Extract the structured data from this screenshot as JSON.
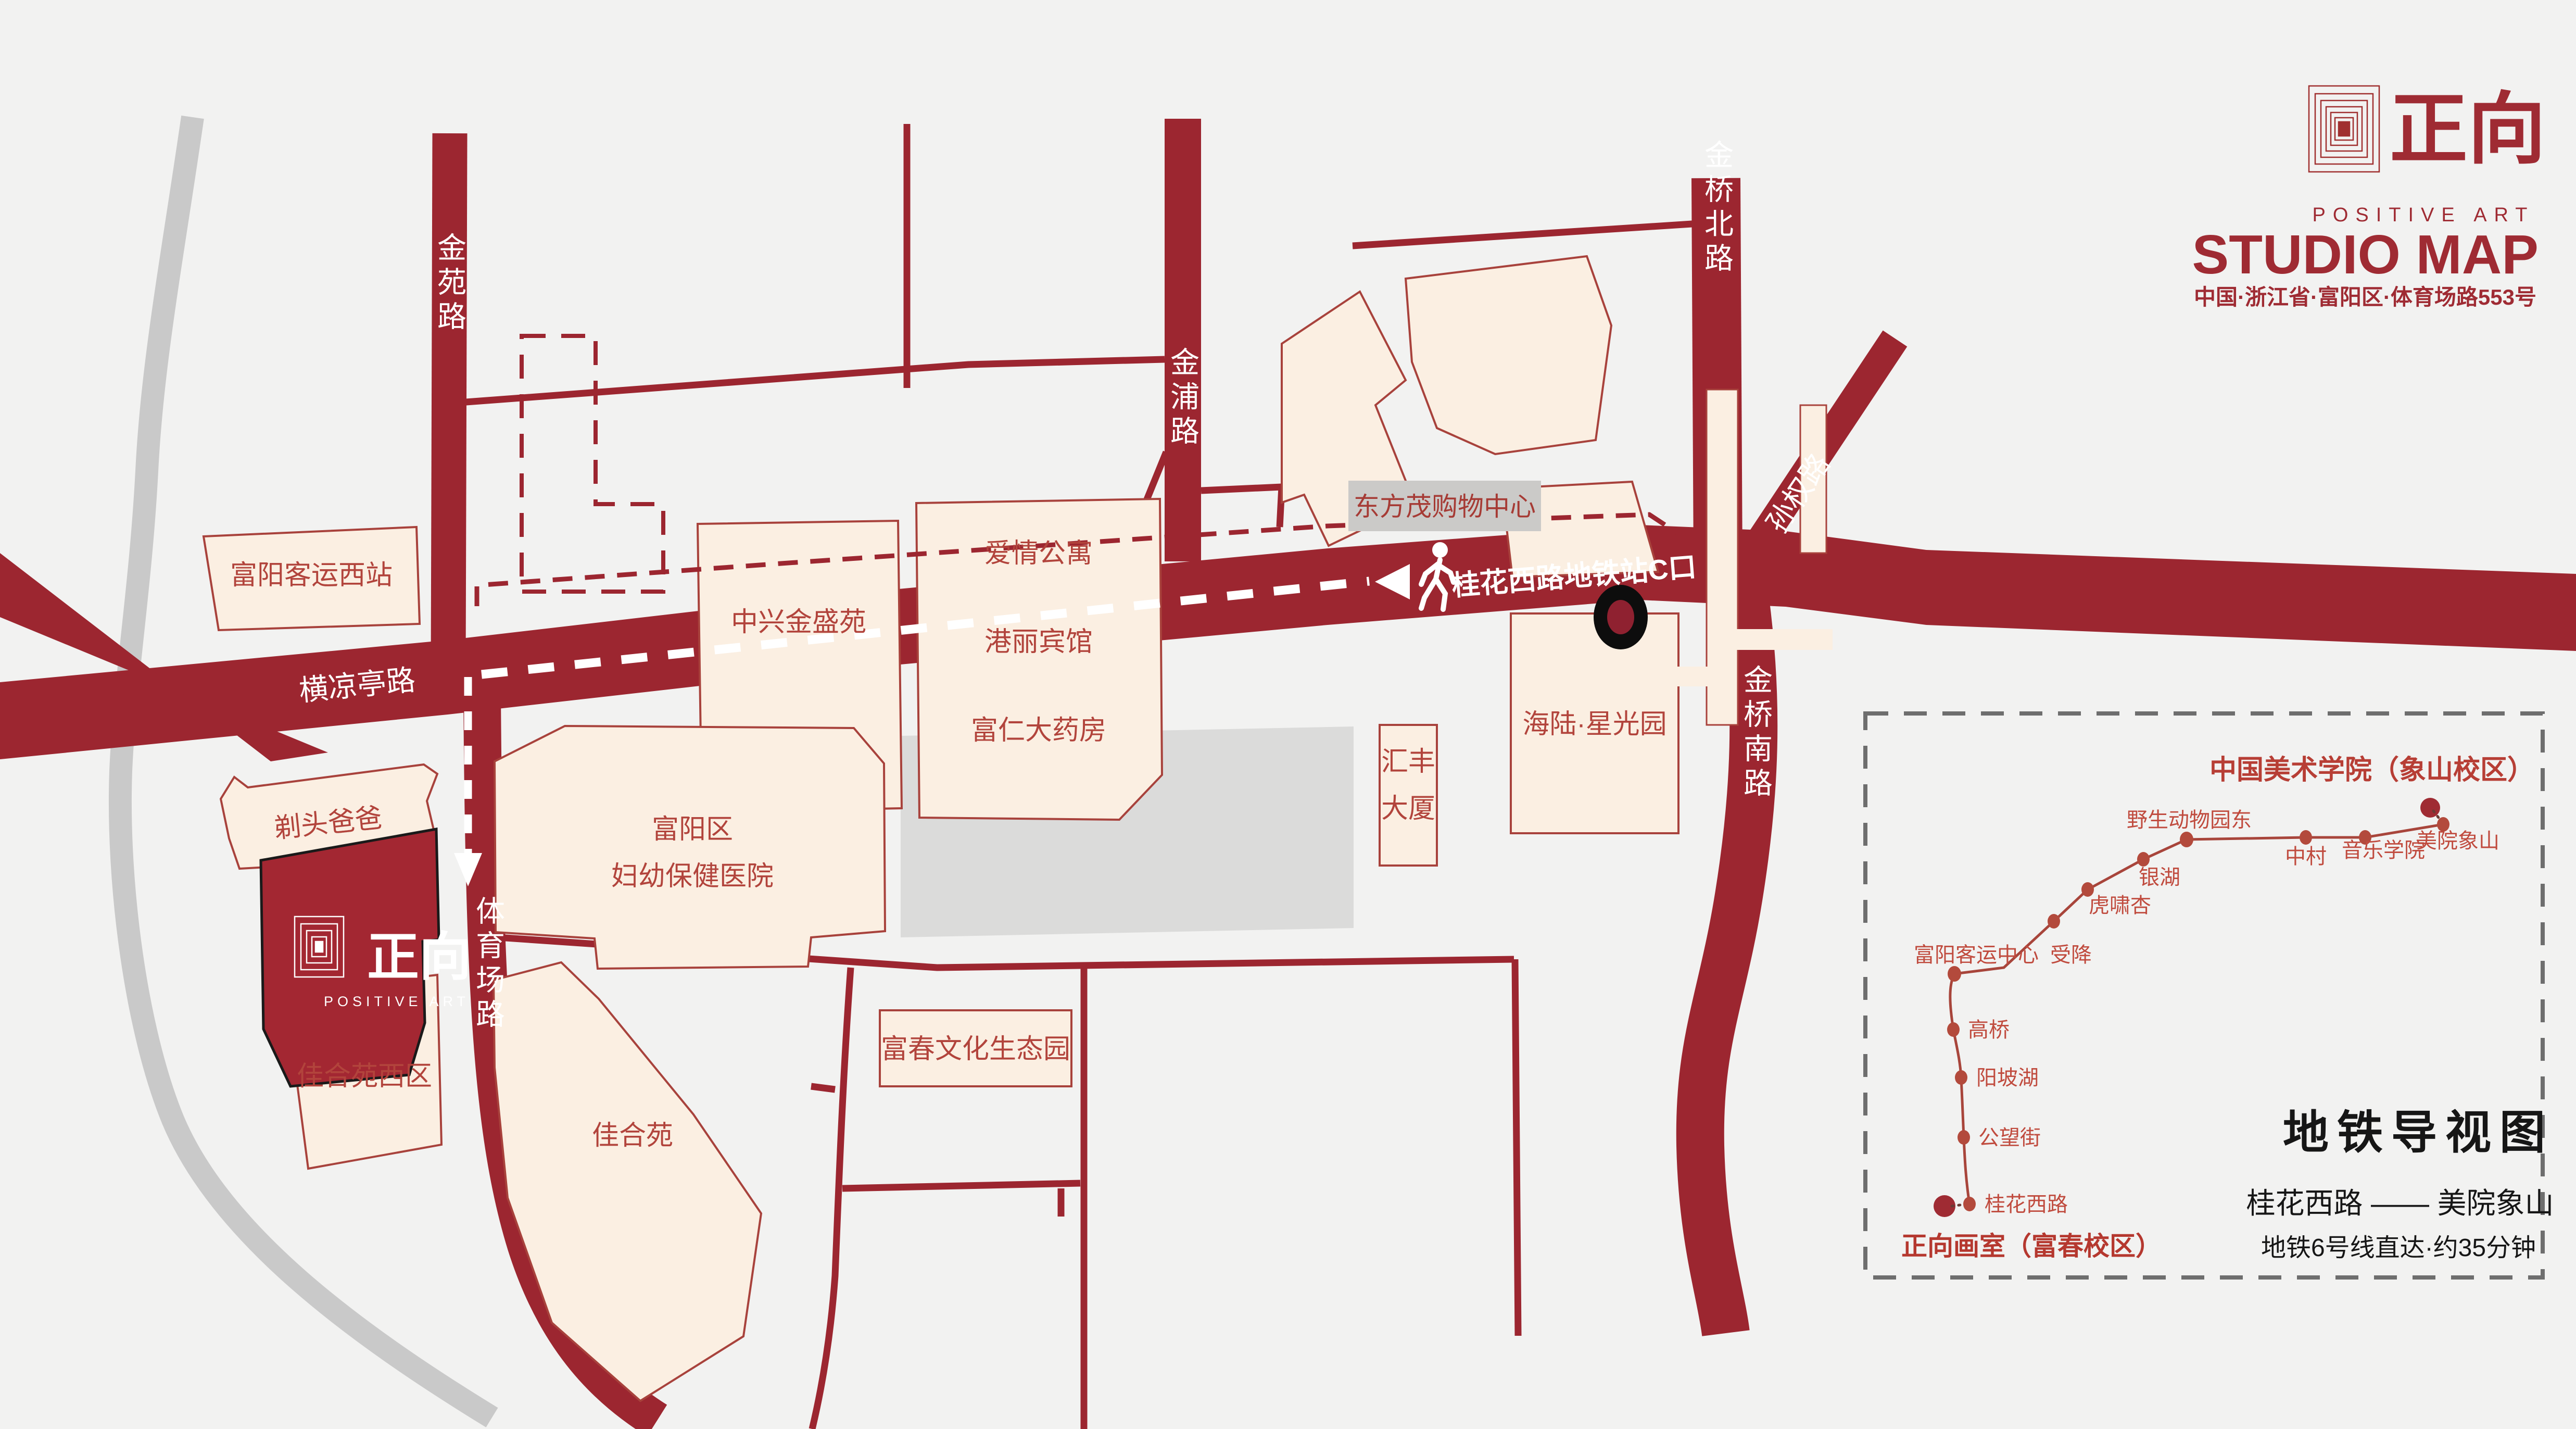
{
  "header": {
    "logo_mark": "seal-icon",
    "logo_text": "正向",
    "logo_subtext": "POSITIVE ART",
    "title": "STUDIO MAP",
    "address": "中国·浙江省·富阳区·体育场路553号"
  },
  "map": {
    "roads": {
      "jinyuan": "金苑路",
      "jinpu": "金浦路",
      "jinqiao_north": "金桥北路",
      "jinqiao_south": "金桥南路",
      "sunquan": "孙权路",
      "hengliangting": "横凉亭路",
      "tiyuchang": "体育场路",
      "metro_exit": "桂花西路地铁站C口"
    },
    "buildings": {
      "west_station": "富阳客运西站",
      "zhongxing": "中兴金盛苑",
      "apartment": "爱情公寓",
      "hotel": "港丽宾馆",
      "pharmacy": "富仁大药房",
      "mall": "东方茂购物中心",
      "huifeng_line1": "汇丰",
      "huifeng_line2": "大厦",
      "hailu": "海陆·星光园",
      "hospital_line1": "富阳区",
      "hospital_line2": "妇幼保健医院",
      "barber": "剃头爸爸",
      "jiaheyuan_west": "佳合苑西区",
      "jiaheyuan": "佳合苑",
      "fuchun_park": "富春文化生态园"
    },
    "studio": {
      "name": "正向",
      "sub": "POSITIVE ART"
    }
  },
  "metro_panel": {
    "title": "地铁导视图",
    "origin_label": "正向画室（富春校区）",
    "dest_label": "中国美术学院（象山校区）",
    "route": "桂花西路 —— 美院象山",
    "note": "地铁6号线直达·约35分钟",
    "line_name": "地铁6号线",
    "stations": [
      "桂花西路",
      "公望街",
      "阳坡湖",
      "高桥",
      "富阳客运中心",
      "受降",
      "虎啸杏",
      "银湖",
      "野生动物园东",
      "中村",
      "音乐学院",
      "美院象山"
    ]
  },
  "colors": {
    "road_red": "#9C2630",
    "building_cream": "#FBEFE2",
    "building_stroke": "#A8423C",
    "label_red": "#B2443C",
    "studio_red": "#A32732",
    "gray_road": "#C9C9C9",
    "gray_block": "#DBDBDA",
    "metro_line": "#A8453B",
    "panel_border": "#6E6E6E",
    "background": "#F2F2F1"
  }
}
